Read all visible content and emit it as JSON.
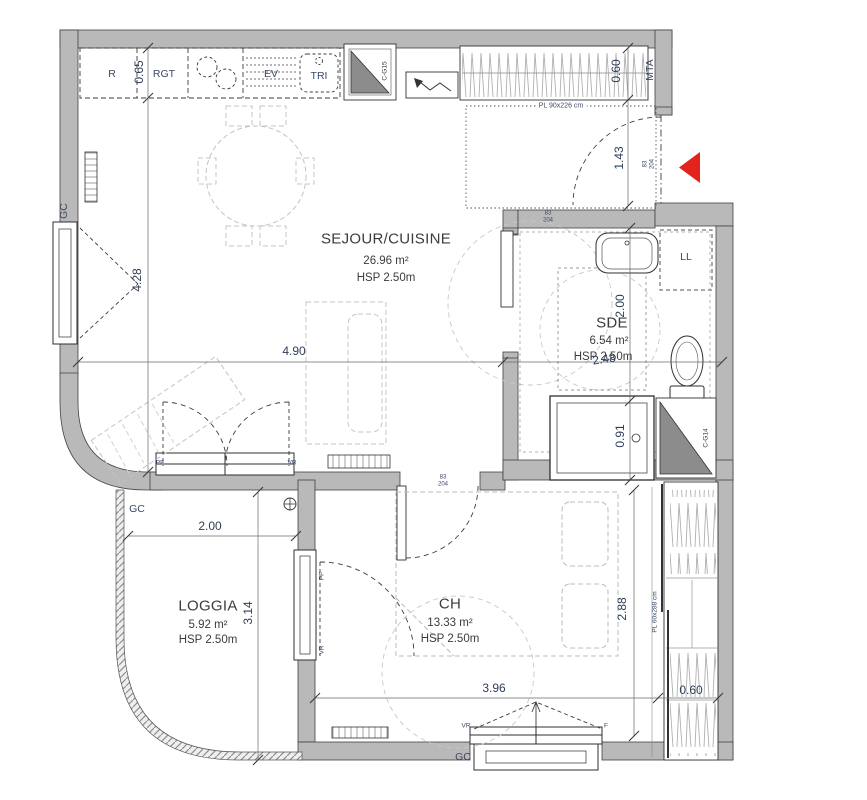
{
  "plan": {
    "type": "apartment-floorplan"
  },
  "colors": {
    "wall": "#b9b9b9",
    "duct_fill": "#8c8c8c",
    "dimension_text": "#2e3d57",
    "room_text": "#3c3c3c",
    "annotation_text": "#3a4868",
    "entrance_arrow": "#e3241d"
  },
  "rooms": [
    {
      "name": "SEJOUR/CUISINE",
      "area": "26.96 m²",
      "ceiling": "HSP 2.50m"
    },
    {
      "name": "SDE",
      "area": "6.54 m²",
      "ceiling": "HSP 2.50m"
    },
    {
      "name": "CH",
      "area": "13.33 m²",
      "ceiling": "HSP 2.50m"
    },
    {
      "name": "LOGGIA",
      "area": "5.92 m²",
      "ceiling": "HSP 2.50m"
    }
  ],
  "dims": {
    "kitchen_depth": "0.65",
    "sejour_height": "4.28",
    "sejour_width": "4.90",
    "entry_closet_depth": "0.60",
    "entry_length": "1.43",
    "sde_height": "2.00",
    "sde_width": "2.48",
    "shower_width": "0.91",
    "loggia_width": "2.00",
    "loggia_height": "3.14",
    "ch_width": "3.96",
    "ch_height": "2.88",
    "ch_closet_depth": "0.60"
  },
  "door_size": {
    "w": "83",
    "h": "204"
  },
  "tags": {
    "fridge": "R",
    "storage": "RGT",
    "sink": "EV",
    "sorting": "TRI",
    "duct_kitchen": "C-G15",
    "duct_bathroom": "C-G14",
    "entry_closet": "MTA",
    "washing_machine": "LL",
    "gc": "GC",
    "closet_entry": "PL 90x226 cm",
    "closet_bedroom": "PL 60x288 cm",
    "tag_pf": "PF",
    "tag_vr": "VR",
    "tag_f": "F"
  }
}
